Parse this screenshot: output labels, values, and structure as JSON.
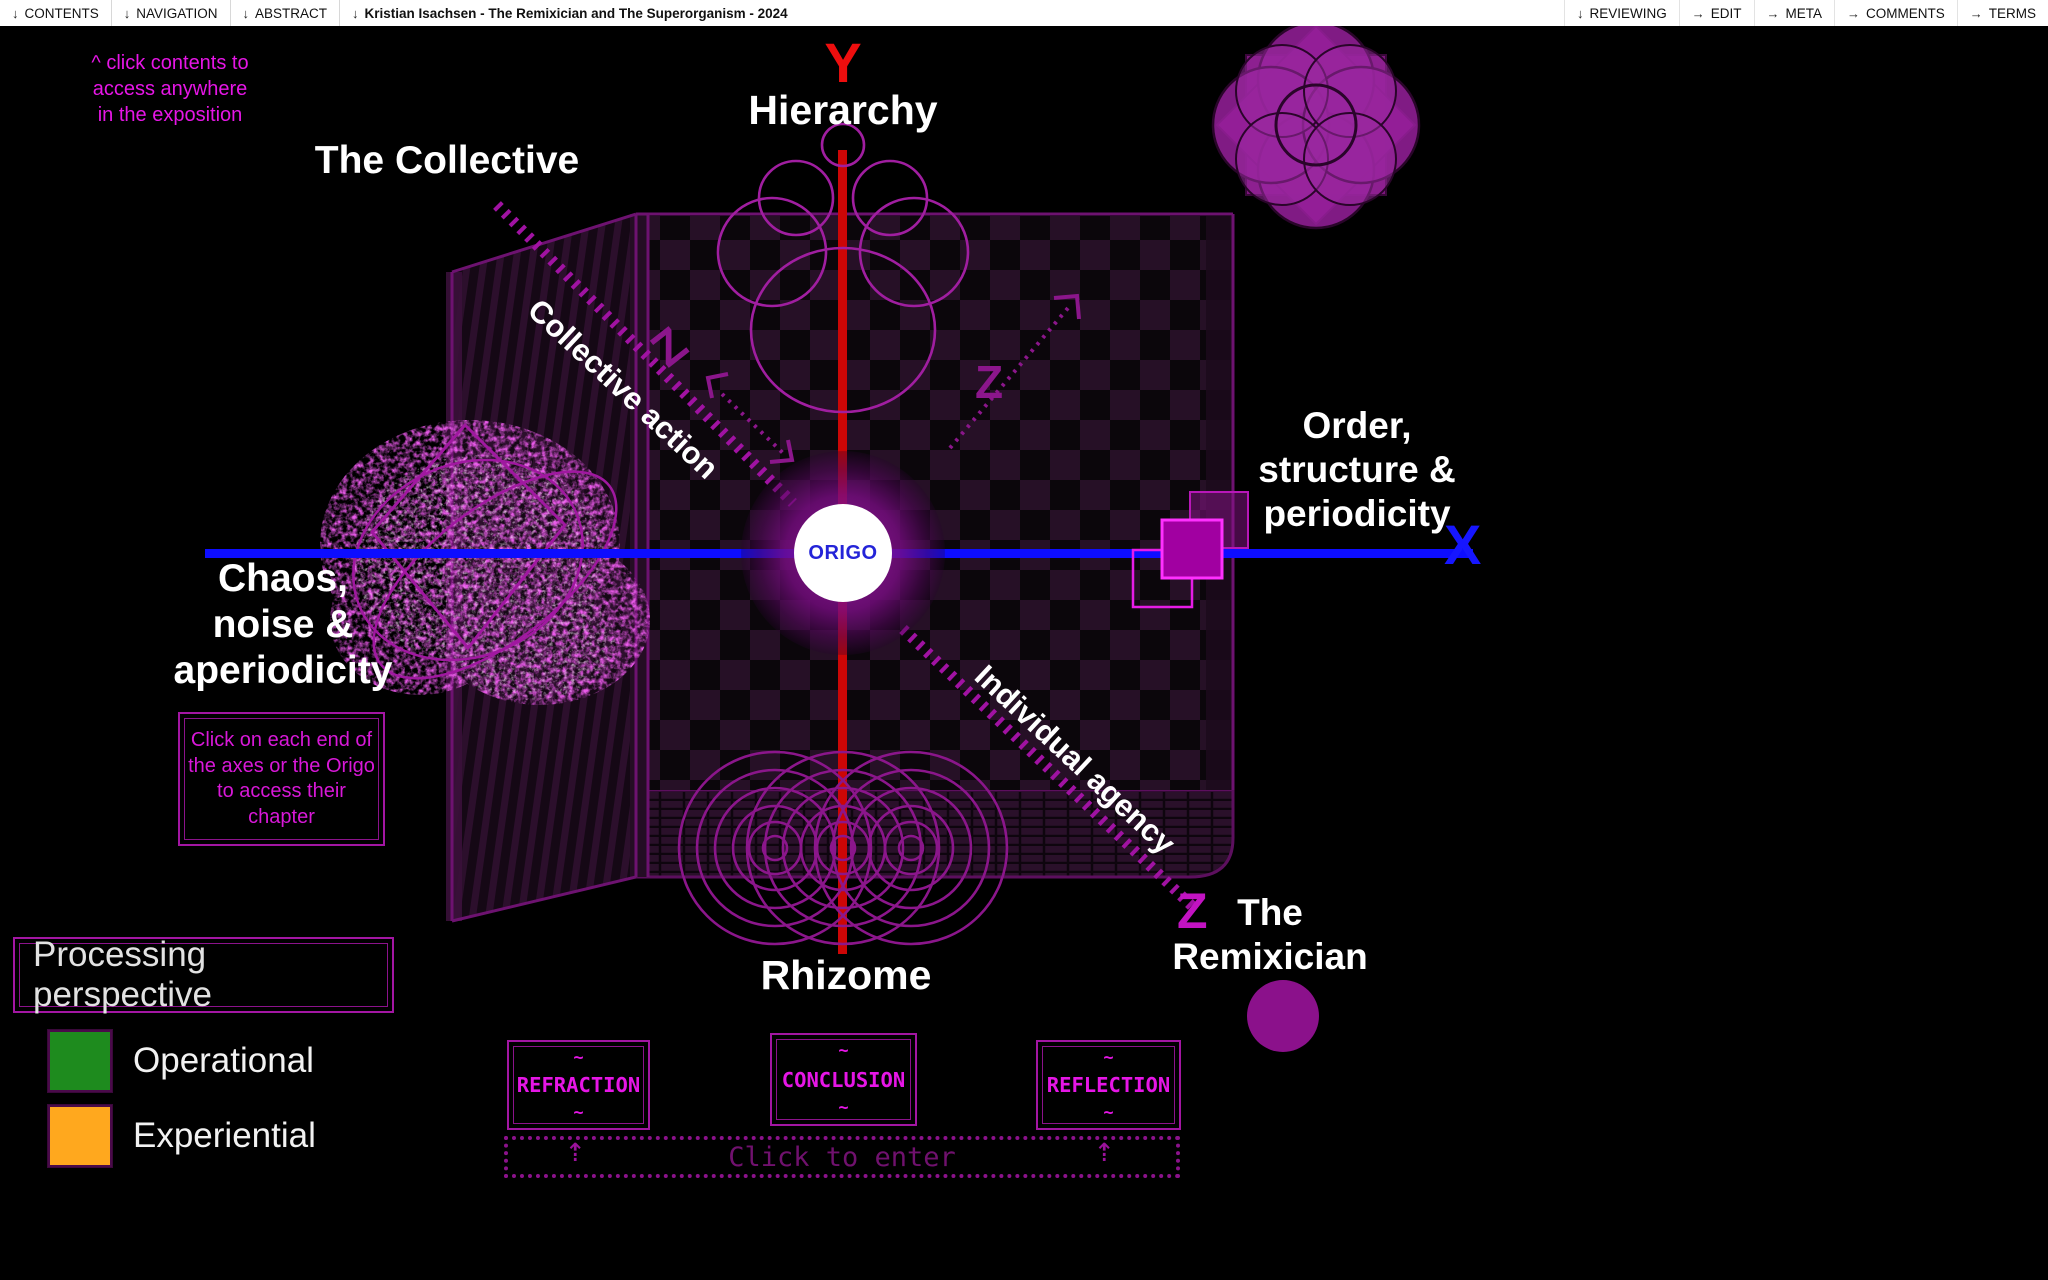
{
  "menu": {
    "left": [
      {
        "prefix": "↓",
        "label": "CONTENTS"
      },
      {
        "prefix": "↓",
        "label": "NAVIGATION"
      },
      {
        "prefix": "↓",
        "label": "ABSTRACT"
      },
      {
        "prefix": "↓",
        "label": "Kristian Isachsen - The Remixician and The Superorganism - 2024"
      }
    ],
    "right": [
      {
        "prefix": "↓",
        "label": "REVIEWING"
      },
      {
        "prefix": "→",
        "label": "EDIT"
      },
      {
        "prefix": "→",
        "label": "META"
      },
      {
        "prefix": "→",
        "label": "COMMENTS"
      },
      {
        "prefix": "→",
        "label": "TERMS"
      }
    ]
  },
  "hint": {
    "lines": [
      "^ click contents to",
      "access anywhere",
      "in the exposition"
    ]
  },
  "diagram": {
    "origo_label": "ORIGO",
    "axis_letters": {
      "x": "X",
      "y": "Y",
      "z": "Z"
    },
    "labels": {
      "hierarchy": "Hierarchy",
      "rhizome": "Rhizome",
      "collective": "The Collective",
      "remixician_lines": [
        "The",
        "Remixician"
      ],
      "order_lines": [
        "Order,",
        "structure &",
        "periodicity"
      ],
      "chaos_lines": [
        "Chaos,",
        "noise &",
        "aperiodicity"
      ],
      "collective_action": "Collective action",
      "individual_agency": "Individual agency"
    },
    "instruction_lines": [
      "Click on each end of",
      "the axes or the Origo",
      "to access their",
      "chapter"
    ],
    "colors": {
      "x_axis": "#0d0dff",
      "y_axis": "#cc0606",
      "z_axis": "#a012a2",
      "accent_magenta": "#e616e6",
      "cube_edge": "#6d1270"
    }
  },
  "legend": {
    "title": "Processing perspective",
    "items": [
      {
        "label": "Operational",
        "color": "#1e8b1e"
      },
      {
        "label": "Experiential",
        "color": "#ffa81e"
      }
    ]
  },
  "chapters": {
    "tilde": "~",
    "items": [
      {
        "label": "REFRACTION"
      },
      {
        "label": "CONCLUSION"
      },
      {
        "label": "REFLECTION"
      }
    ],
    "enter_label": "Click to enter",
    "arrow": "⇡"
  }
}
